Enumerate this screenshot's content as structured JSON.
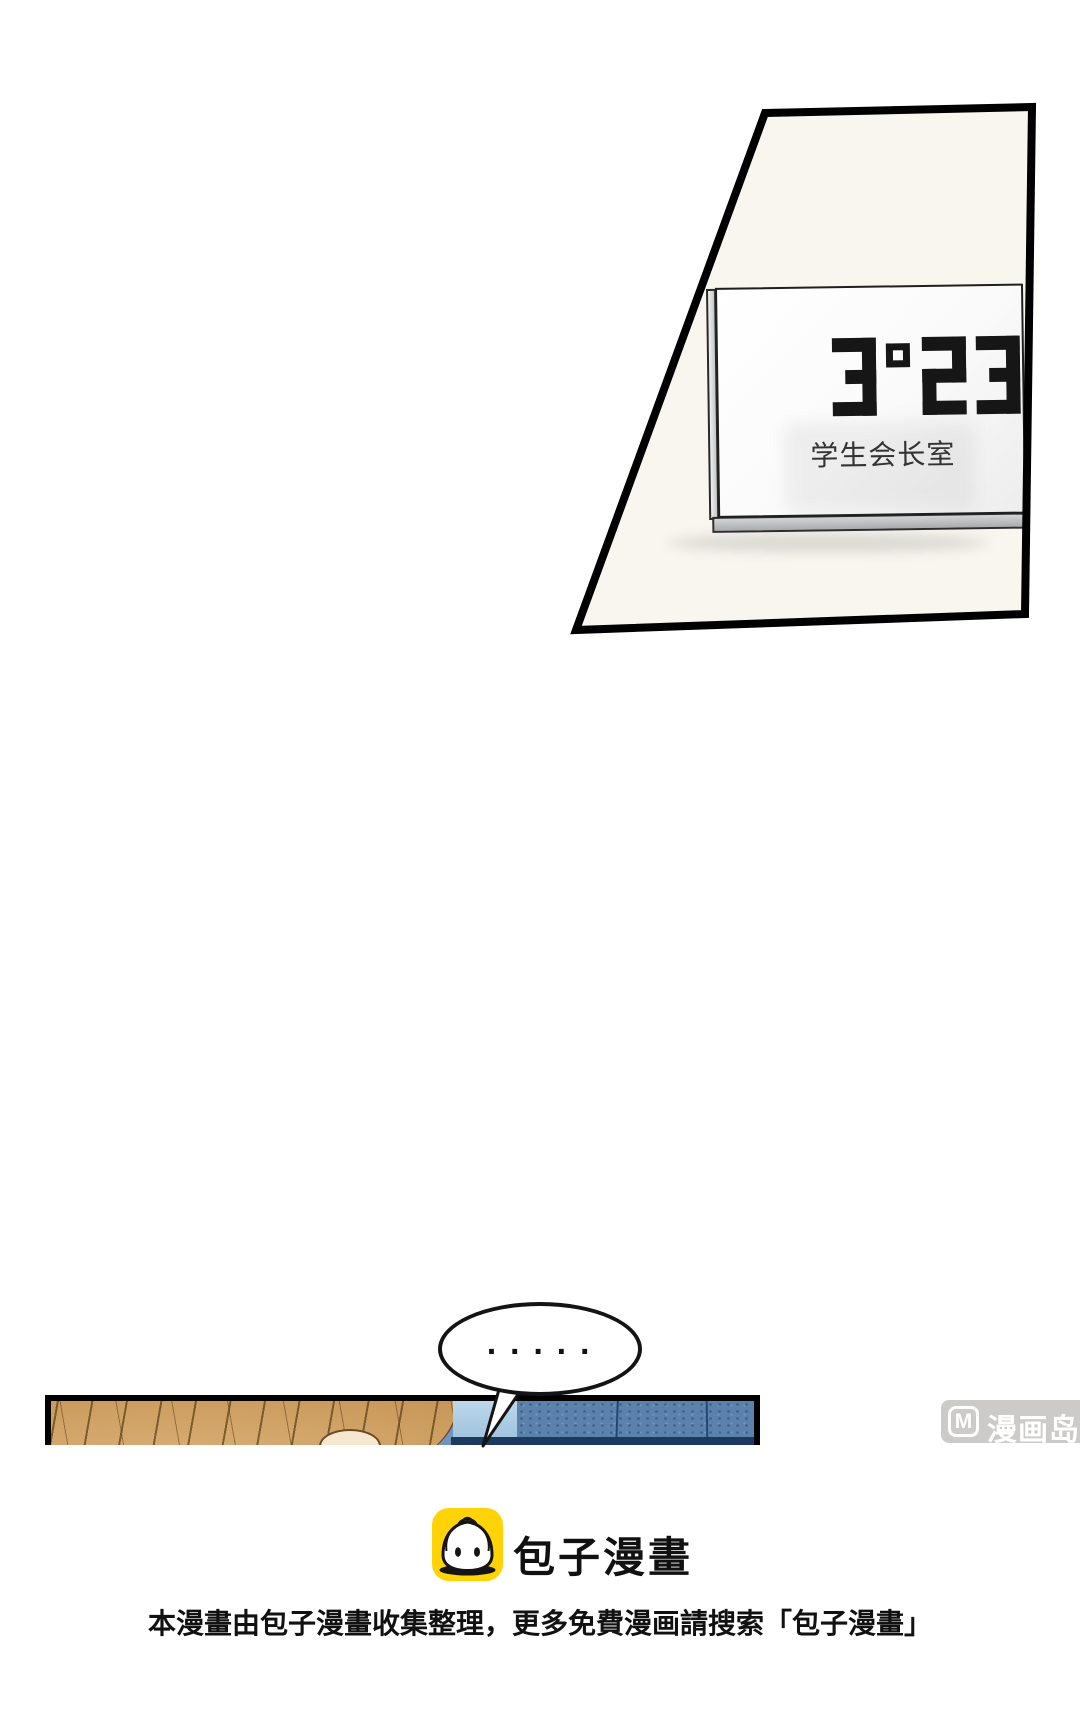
{
  "page": {
    "background": "#ffffff"
  },
  "top_panel": {
    "wall_color": "#f8f6ef",
    "sign": {
      "room_number": "3º23",
      "room_label": "学生会长室",
      "plate_color": "#fdfdfd"
    }
  },
  "speech_bubble": {
    "text": "·····"
  },
  "comic_panel": {
    "hair_color": "#cfa164",
    "background_blue": "#5b81ad",
    "light_blue": "#aac9e2"
  },
  "watermark": {
    "badge_color": "#cccccc",
    "logo_letter": "M",
    "site_name": "漫画岛"
  },
  "branding": {
    "icon_name": "baozi-bun-icon",
    "icon_color": "#ffd306",
    "logo_text": "包子漫畫"
  },
  "footer": {
    "text": "本漫畫由包子漫畫收集整理，更多免費漫画請搜索「包子漫畫」"
  }
}
